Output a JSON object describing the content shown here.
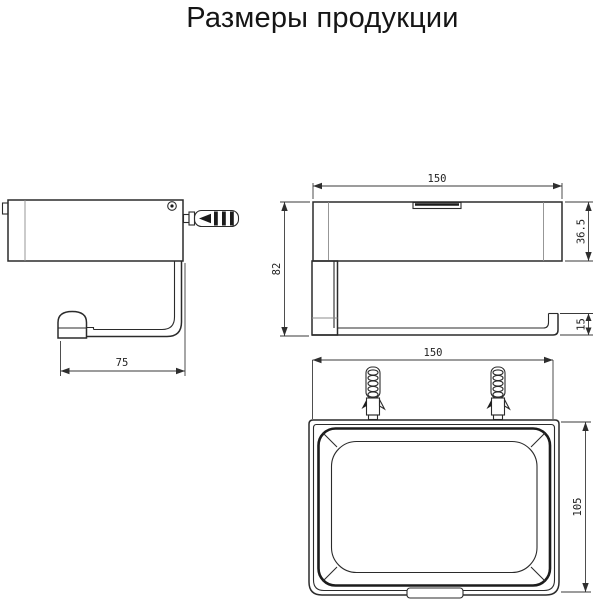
{
  "title": "Размеры продукции",
  "colors": {
    "background": "#ffffff",
    "line": "#2b2b2b",
    "dimension_line": "#3a3a3a"
  },
  "views": {
    "side": {
      "name": "side view with wall anchor",
      "width_mm": "75"
    },
    "front": {
      "name": "front view",
      "width_mm": "150",
      "height_mm": "82",
      "body_height_mm": "36.5",
      "bar_height_mm": "15"
    },
    "top": {
      "name": "top view with mounting screws",
      "width_mm": "150",
      "depth_mm": "105"
    }
  }
}
